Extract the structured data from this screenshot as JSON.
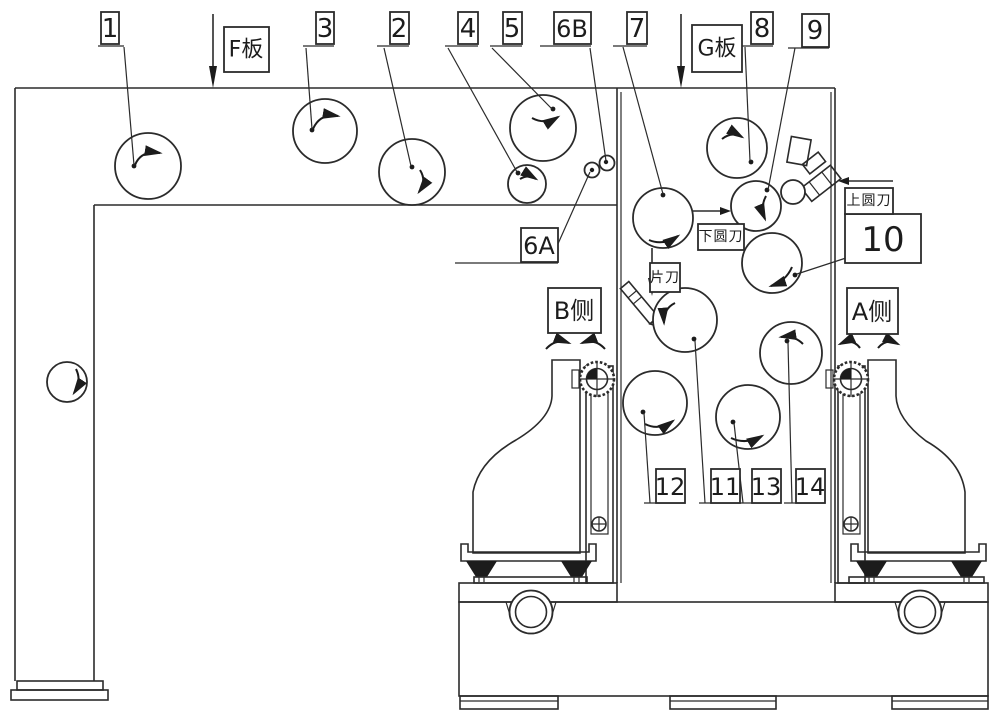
{
  "figure": {
    "background": "#ffffff",
    "line_color": "#2b2b2b",
    "part_labels": {
      "n1": "1",
      "n2": "2",
      "n3": "3",
      "n4": "4",
      "n5": "5",
      "n6a": "6A",
      "n6b": "6B",
      "n7": "7",
      "n8": "8",
      "n9": "9",
      "n10": "10",
      "n11": "11",
      "n12": "12",
      "n13": "13",
      "n14": "14"
    },
    "annotations": {
      "f_plate": "F板",
      "g_plate": "G板",
      "b_side": "B侧",
      "a_side": "A侧",
      "upper_circular_cutter": "上圆刀",
      "lower_circular_cutter": "下圆刀",
      "sheet_cutter": "片刀"
    }
  }
}
